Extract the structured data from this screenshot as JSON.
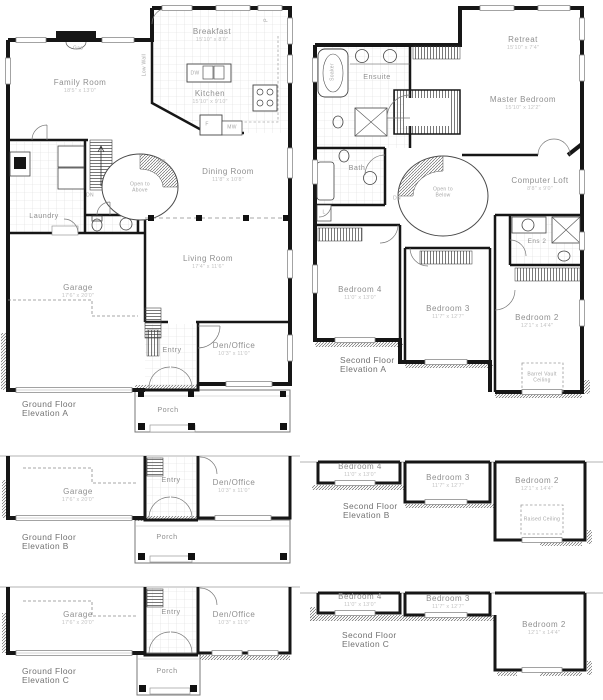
{
  "document_title": "House floor plans - three elevations",
  "colors": {
    "wall": "#161616",
    "tile_line": "#d9d9d9",
    "hatch": "#4a4a4a",
    "window": "#9a9a9a",
    "room_label": "#8f8f8f",
    "dims_label": "#c3c3c3",
    "caption": "#717171",
    "annotation": "#a6a6a6",
    "background": "#ffffff"
  },
  "plans": {
    "ground_a": {
      "caption": {
        "line1": "Ground Floor",
        "line2": "Elevation A"
      },
      "rooms": {
        "family_room": {
          "name": "Family Room",
          "dims": "18'5\" x 13'0\""
        },
        "breakfast": {
          "name": "Breakfast",
          "dims": "15'10\" x 8'0\""
        },
        "kitchen": {
          "name": "Kitchen",
          "dims": "15'10\" x 9'10\""
        },
        "dining_room": {
          "name": "Dining Room",
          "dims": "11'8\" x 10'8\""
        },
        "living_room": {
          "name": "Living Room",
          "dims": "17'4\" x 11'6\""
        },
        "garage": {
          "name": "Garage",
          "dims": "17'6\" x 20'0\""
        },
        "den_office": {
          "name": "Den/Office",
          "dims": "10'3\" x 11'0\""
        },
        "laundry": {
          "name": "Laundry"
        },
        "entry": {
          "name": "Entry"
        },
        "porch": {
          "name": "Porch"
        }
      },
      "annotations": {
        "gas": "Gas",
        "low_wall": "Low Wall",
        "open_to_above": "Open to Above",
        "up": "UP",
        "dn": "DN",
        "dishwasher": "DW",
        "fridge": "F",
        "microwave": "MW",
        "pantry": "P"
      }
    },
    "second_a": {
      "caption": {
        "line1": "Second Floor",
        "line2": "Elevation A"
      },
      "rooms": {
        "retreat": {
          "name": "Retreat",
          "dims": "15'10\" x 7'4\""
        },
        "master_bedroom": {
          "name": "Master Bedroom",
          "dims": "15'10\" x 12'2\""
        },
        "computer_loft": {
          "name": "Computer Loft",
          "dims": "8'8\" x 9'0\""
        },
        "bedroom_4": {
          "name": "Bedroom 4",
          "dims": "11'0\" x 13'0\""
        },
        "bedroom_3": {
          "name": "Bedroom 3",
          "dims": "11'7\" x 12'7\""
        },
        "bedroom_2": {
          "name": "Bedroom 2",
          "dims": "12'1\" x 14'4\""
        },
        "ensuite": {
          "name": "Ensuite"
        },
        "bath": {
          "name": "Bath"
        },
        "ens_2": {
          "name": "Ens 2"
        }
      },
      "annotations": {
        "soaker": "Soaker",
        "dn": "DN",
        "open_to_below": "Open to Below",
        "linen": "L",
        "barrel_vault": "Barrel Vault Ceiling"
      }
    },
    "ground_b": {
      "caption": {
        "line1": "Ground Floor",
        "line2": "Elevation B"
      },
      "rooms": {
        "garage": {
          "name": "Garage",
          "dims": "17'6\" x 20'0\""
        },
        "den_office": {
          "name": "Den/Office",
          "dims": "10'3\" x 11'0\""
        },
        "entry": {
          "name": "Entry"
        },
        "porch": {
          "name": "Porch"
        }
      }
    },
    "second_b": {
      "caption": {
        "line1": "Second Floor",
        "line2": "Elevation B"
      },
      "rooms": {
        "bedroom_4": {
          "name": "Bedroom 4",
          "dims": "11'0\" x 13'0\""
        },
        "bedroom_3": {
          "name": "Bedroom 3",
          "dims": "11'7\" x 12'7\""
        },
        "bedroom_2": {
          "name": "Bedroom 2",
          "dims": "12'1\" x 14'4\""
        }
      },
      "annotations": {
        "raised_ceiling": "Raised Ceiling"
      }
    },
    "ground_c": {
      "caption": {
        "line1": "Ground Floor",
        "line2": "Elevation C"
      },
      "rooms": {
        "garage": {
          "name": "Garage",
          "dims": "17'6\" x 20'0\""
        },
        "den_office": {
          "name": "Den/Office",
          "dims": "10'3\" x 11'0\""
        },
        "entry": {
          "name": "Entry"
        },
        "porch": {
          "name": "Porch"
        }
      }
    },
    "second_c": {
      "caption": {
        "line1": "Second Floor",
        "line2": "Elevation C"
      },
      "rooms": {
        "bedroom_4": {
          "name": "Bedroom 4",
          "dims": "11'0\" x 13'0\""
        },
        "bedroom_3": {
          "name": "Bedroom 3",
          "dims": "11'7\" x 12'7\""
        },
        "bedroom_2": {
          "name": "Bedroom 2",
          "dims": "12'1\" x 14'4\""
        }
      }
    }
  }
}
